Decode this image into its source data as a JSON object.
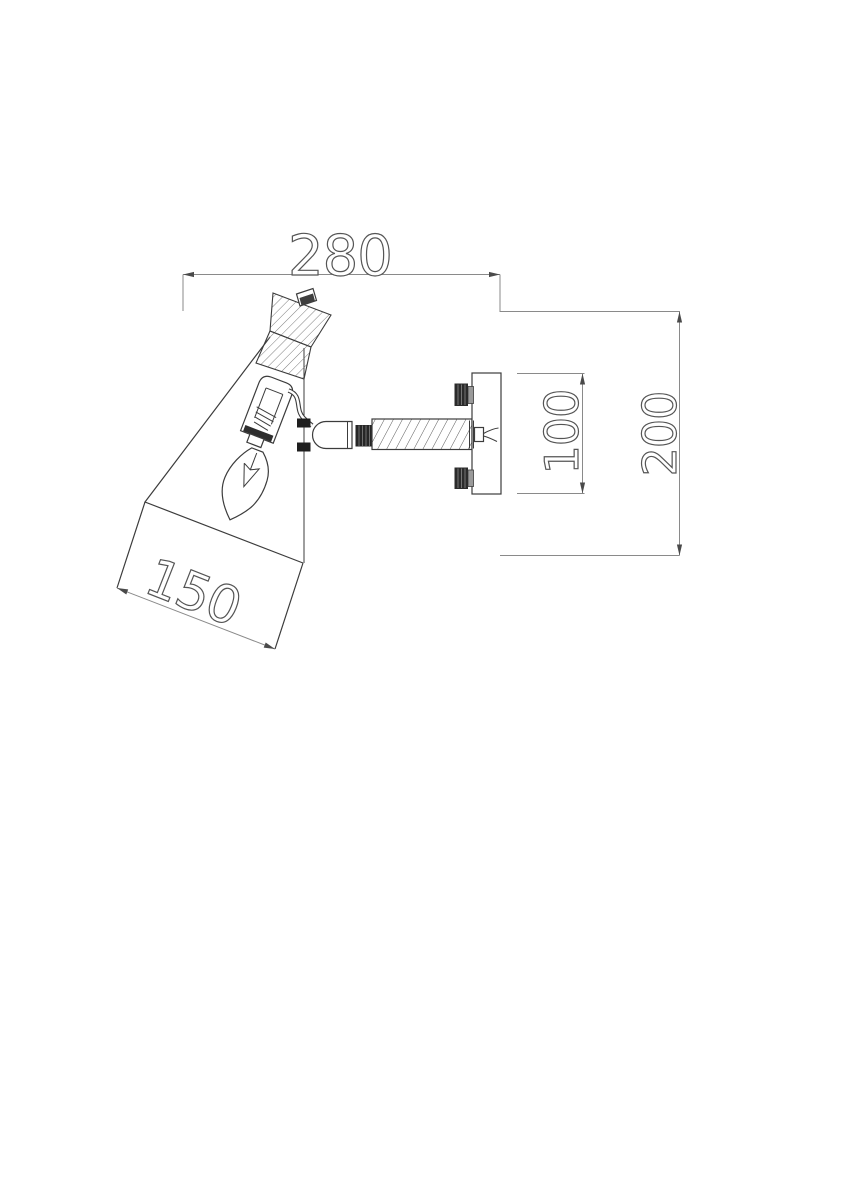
{
  "drawing": {
    "description": "Technical side-elevation drawing of a wall-mounted adjustable spotlight: section-hatched shade holder, conical shade with candle bulb, swivel knuckle on a threaded arm, and rectangular wall plate with two fixing bolts",
    "background_color": "#ffffff",
    "outline_color": "#3c3c3c",
    "dimension_line_color": "#8a8a8a",
    "dimensions": {
      "overall_width": {
        "label": "280"
      },
      "overall_height": {
        "label": "200"
      },
      "wall_plate_height": {
        "label": "100"
      },
      "shade_opening": {
        "label": "150"
      }
    }
  }
}
